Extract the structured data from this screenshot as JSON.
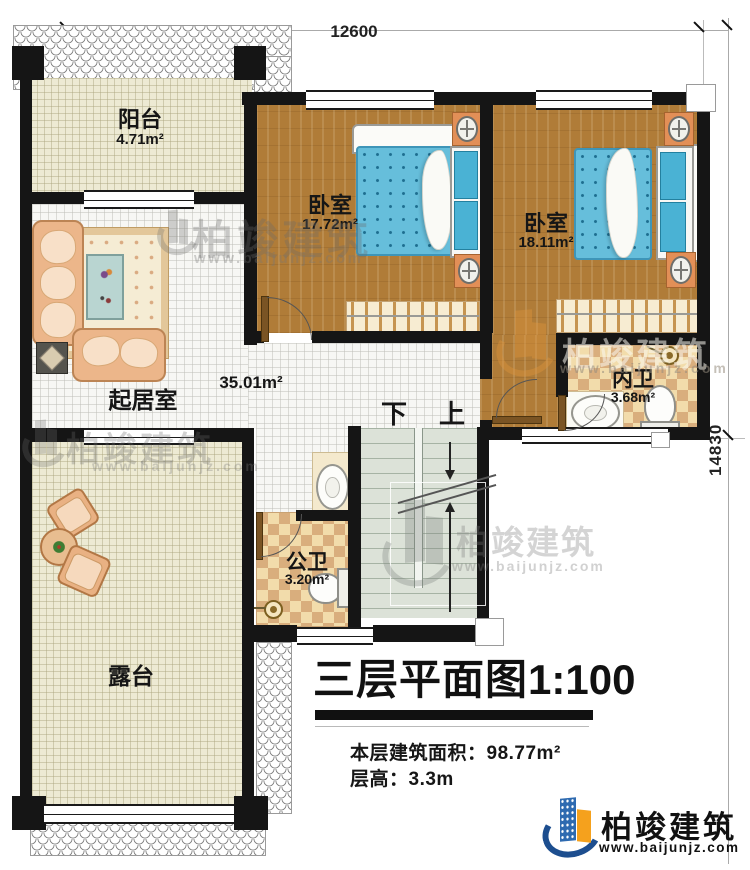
{
  "plan": {
    "type": "floor-plan",
    "floor": "三层",
    "scale": "1:100"
  },
  "dimensions": {
    "top": "12600",
    "right": "14830"
  },
  "rooms": {
    "balcony": {
      "name": "阳台",
      "area": "4.71m²"
    },
    "bedroom1": {
      "name": "卧室",
      "area": "17.72m²"
    },
    "bedroom2": {
      "name": "卧室",
      "area": "18.11m²"
    },
    "living": {
      "name": "起居室",
      "area": "35.01m²"
    },
    "inner_bath": {
      "name": "内卫",
      "area": "3.68m²"
    },
    "public_bath": {
      "name": "公卫",
      "area": "3.20m²"
    },
    "terrace": {
      "name": "露台"
    }
  },
  "stairs": {
    "down": "下",
    "up": "上"
  },
  "title": {
    "name": "三层平面图",
    "scale": "1:100"
  },
  "info": {
    "area_label": "本层建筑面积：",
    "area_value": "98.77m²",
    "floor_height_label": "层高：",
    "floor_height_value": "3.3m"
  },
  "brand": {
    "name": "柏竣建筑",
    "website": "www.baijunjz.com"
  },
  "watermark": {
    "name": "柏竣建筑",
    "website": "www.baijunjz.com"
  },
  "icons": {
    "ac_unit": "fan-coil-unit-icon",
    "shower": "shower-head-icon",
    "logo": "baijun-building-logo-icon"
  },
  "colors": {
    "wall": "#151515",
    "wood_floor": "#b07c38",
    "mattress_blue": "#66bedb",
    "checker_tile": "#e8c795",
    "brand_blue": "#2e6ab0",
    "brand_navy": "#1d4e8f",
    "brand_orange": "#f5a11d"
  }
}
